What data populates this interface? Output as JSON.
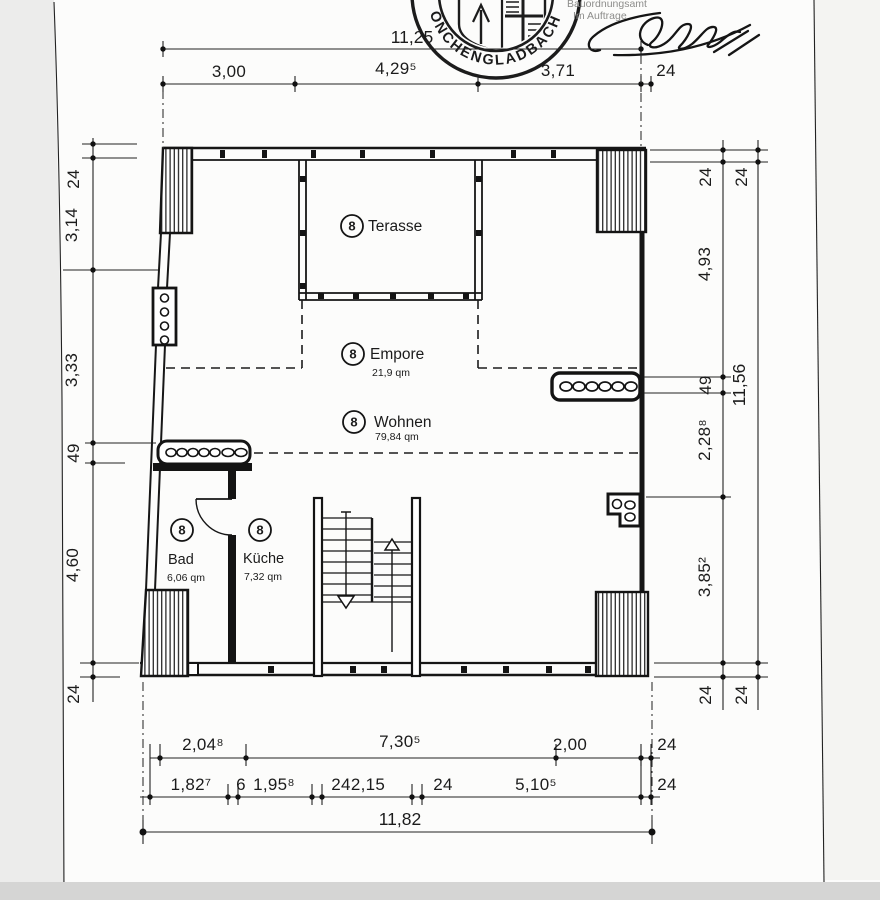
{
  "stamp": {
    "ring_text": "ÖNCHENGLADBACH",
    "office_line1": "Bauordnungsamt",
    "office_line2": "Im Auftrage"
  },
  "dimensions": {
    "top_overall": "11,25",
    "top_segments": [
      "3,00",
      "4,29⁵",
      "3,71",
      "24"
    ],
    "left_segments": [
      "24",
      "3,14",
      "3,33",
      "49",
      "4,60",
      "24"
    ],
    "right_inner_segments": [
      "24",
      "4,93",
      "49",
      "2,28⁸",
      "3,85²",
      "24"
    ],
    "right_outer_segments": [
      "24",
      "11,56",
      "24"
    ],
    "bottom_row1": [
      "2,04⁸",
      "7,30⁵",
      "2,00",
      "24"
    ],
    "bottom_row2": [
      "1,82⁷",
      "6",
      "1,95⁸",
      "24",
      "2,15",
      "24",
      "5,10⁵",
      "24"
    ],
    "bottom_overall": "11,82"
  },
  "rooms": {
    "terasse": {
      "number": "8",
      "name": "Terasse"
    },
    "empore": {
      "number": "8",
      "name": "Empore",
      "area": "21,9 qm"
    },
    "wohnen": {
      "number": "8",
      "name": "Wohnen",
      "area": "79,84 qm"
    },
    "bad": {
      "number": "8",
      "name": "Bad",
      "area": "6,06 qm"
    },
    "kueche": {
      "number": "8",
      "name": "Küche",
      "area": "7,32 qm"
    }
  }
}
